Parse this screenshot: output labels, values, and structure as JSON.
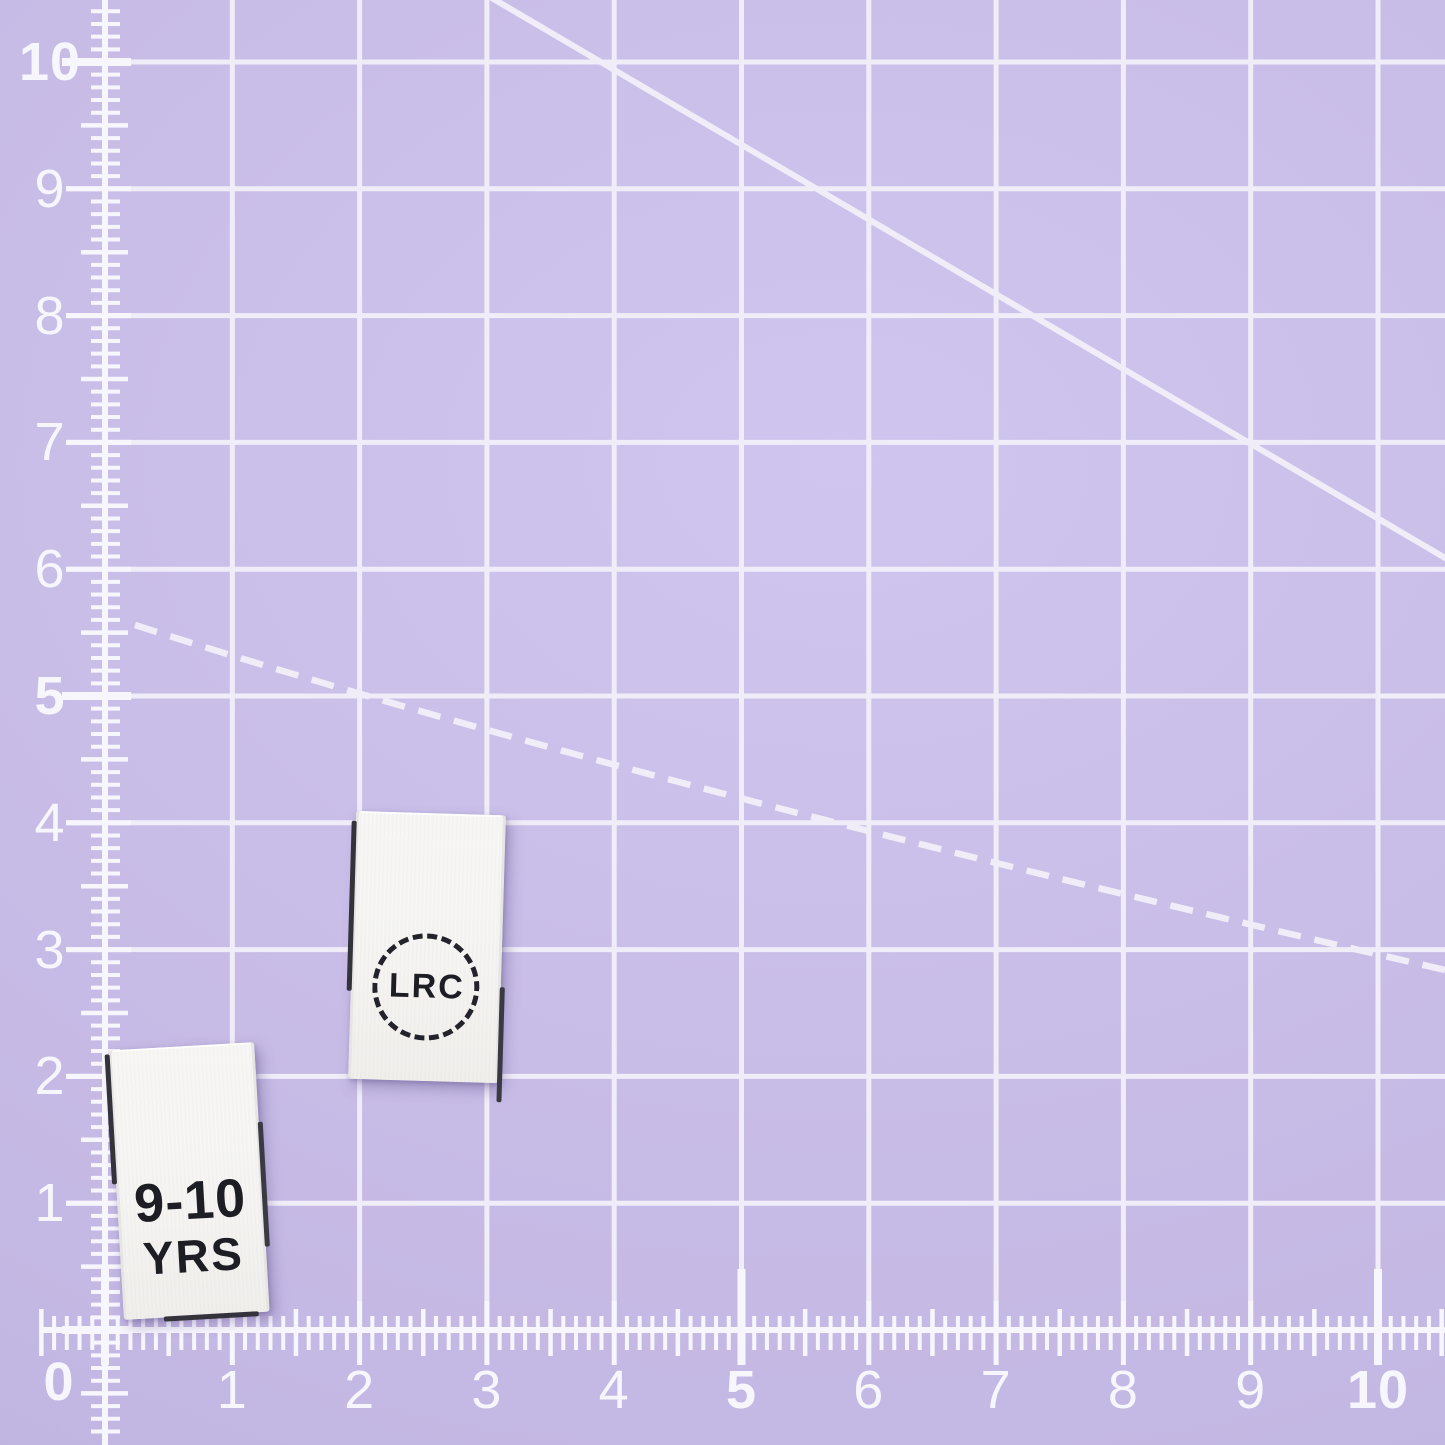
{
  "scene": {
    "mat_color": "#c8bde7",
    "grid_color": "#f1edf8",
    "marking_color": "#f8f6fd",
    "label_fabric_color": "#f6f5f3",
    "label_text_color": "#1d1d24"
  },
  "rulers": {
    "left_numbers": [
      "10",
      "9",
      "8",
      "7",
      "6",
      "5",
      "4",
      "3",
      "2",
      "1"
    ],
    "bottom_numbers": [
      "0",
      "1",
      "2",
      "3",
      "4",
      "5",
      "6",
      "7",
      "8",
      "9",
      "10"
    ],
    "bold_numbers": [
      "0",
      "5",
      "10"
    ]
  },
  "labels": {
    "logo_label": {
      "text": "LRC"
    },
    "size_label": {
      "line1": "9-10",
      "line2": "YRS"
    }
  }
}
